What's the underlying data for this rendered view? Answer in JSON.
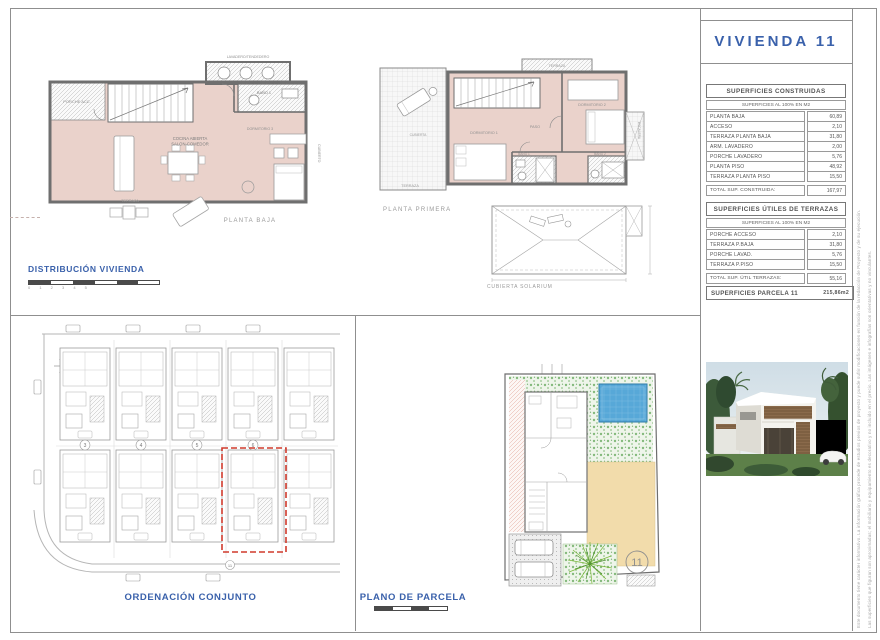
{
  "title_block": {
    "title": "VIVIENDA 11"
  },
  "section_labels": {
    "distribucion": "DISTRIBUCIÓN VIVIENDA",
    "planta_baja": "PLANTA BAJA",
    "planta_primera": "PLANTA PRIMERA",
    "cubierta": "CUBIERTA SOLARIUM",
    "ordenacion": "ORDENACIÓN CONJUNTO",
    "plano_parcela": "PLANO DE PARCELA",
    "scale_ticks": "0 1 2 3 4 5"
  },
  "tables": {
    "construidas": {
      "title": "SUPERFICIES CONSTRUIDAS",
      "subtitle": "SUPERFICIES AL 100% EN M2",
      "rows": [
        [
          "PLANTA BAJA",
          "60,89"
        ],
        [
          "ACCESO",
          "2,10"
        ],
        [
          "TERRAZA PLANTA BAJA",
          "31,80"
        ],
        [
          "ARM. LAVADERO",
          "2,00"
        ],
        [
          "PORCHE LAVADERO",
          "5,76"
        ],
        [
          "PLANTA PISO",
          "48,92"
        ],
        [
          "TERRAZA PLANTA PISO",
          "15,50"
        ]
      ],
      "total_label": "TOTAL SUP. CONSTRUIDA:",
      "total_value": "167,97"
    },
    "terrazas": {
      "title": "SUPERFICIES ÚTILES DE TERRAZAS",
      "subtitle": "SUPERFICIES AL 100% EN M2",
      "rows": [
        [
          "PORCHE ACCESO",
          "2,10"
        ],
        [
          "TERRAZA P.BAJA",
          "31,80"
        ],
        [
          "PORCHE LAVAD.",
          "5,76"
        ],
        [
          "TERRAZA P.PISO",
          "15,50"
        ]
      ],
      "total_label": "TOTAL SUP. ÚTIL TERRAZAS:",
      "total_value": "55,16"
    },
    "parcela": {
      "label": "SUPERFICIES PARCELA 11",
      "value": "215,86m2"
    }
  },
  "plans": {
    "planta_baja": {
      "rooms": [
        "PORCHE ACC.",
        "LAVADERO/TENDEDERO",
        "BAÑO 1",
        "COCINA ABIERTA",
        "SALON-COMEDOR",
        "DORMITORIO 3",
        "TERRAZA",
        "CUBIERTO"
      ]
    },
    "planta_primera": {
      "rooms": [
        "TERRAZA",
        "CUBIERTA",
        "DORMITORIO 1",
        "PASO",
        "DORMITORIO 2",
        "TERRAZA",
        "BAÑO 1",
        "BAÑO 2",
        "ESCALERA"
      ]
    }
  },
  "site_plan": {
    "unit_numbers": [
      "3",
      "4",
      "5",
      "6"
    ],
    "highlight_number": "11"
  },
  "parcel_plan": {
    "number": "11"
  },
  "disclaimer": {
    "line1": "Este documento tiene carácter informativo. La información gráfica procede de estudios previos de proyecto y puede sufrir modificaciones en función de la redacción de Proyecto y de su ejecución.",
    "line2": "Las superficies que figuran son aproximadas; el mobiliario y equipamiento es decorativo y no incluido en el precio. Las imágenes e infografías son orientativas y no vinculantes."
  },
  "colors": {
    "accent_blue": "#3a61ab",
    "highlight_red": "#d03a2c",
    "plan_pink": "#ead2cb",
    "pool_blue": "#57a8d8"
  }
}
